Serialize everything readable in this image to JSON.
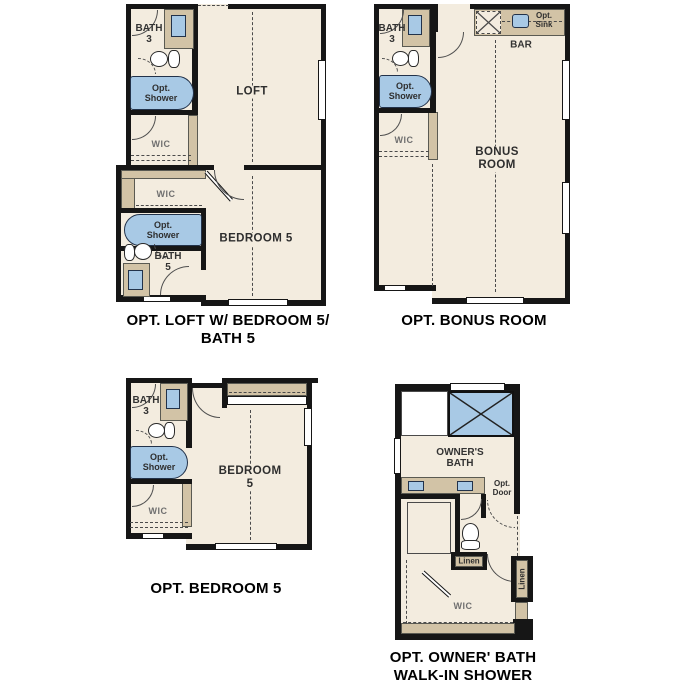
{
  "colors": {
    "floor": "#f3ecdf",
    "cabinet": "#d2c3a6",
    "fixture_blue": "#a8c9e5",
    "wall": "#161616",
    "window": "#ffffff",
    "caption_text": "#000000"
  },
  "plans": {
    "p1": {
      "caption": "OPT. LOFT W/ BEDROOM 5/\nBATH 5",
      "labels": {
        "bath3": "BATH\n3",
        "opt_shower_upper": "Opt.\nShower",
        "wic_upper": "WIC",
        "loft": "LOFT",
        "wic_lower": "WIC",
        "opt_shower_lower": "Opt.\nShower",
        "bath5": "BATH\n5",
        "bedroom5": "BEDROOM 5"
      }
    },
    "p2": {
      "caption": "OPT. BONUS ROOM",
      "labels": {
        "bath3": "BATH\n3",
        "opt_shower": "Opt.\nShower",
        "wic": "WIC",
        "opt_sink": "Opt.\nSink",
        "bar": "BAR",
        "bonus_room": "BONUS\nROOM"
      }
    },
    "p3": {
      "caption": "OPT. BEDROOM 5",
      "labels": {
        "bath3": "BATH\n3",
        "opt_shower": "Opt.\nShower",
        "wic": "WIC",
        "bedroom5": "BEDROOM 5"
      }
    },
    "p4": {
      "caption": "OPT. OWNER' BATH\nWALK-IN SHOWER",
      "labels": {
        "owners_bath": "OWNER'S\nBATH",
        "opt_door": "Opt.\nDoor",
        "linen_horizontal": "Linen",
        "linen_vertical": "Linen",
        "wic": "WIC"
      }
    }
  }
}
